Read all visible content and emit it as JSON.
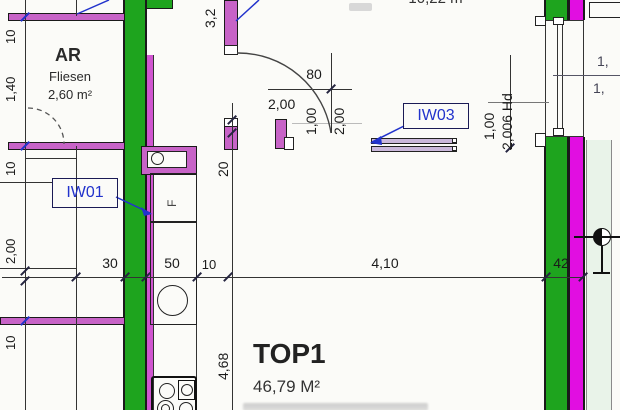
{
  "plan": {
    "rooms": {
      "ar": {
        "label": "AR",
        "finish": "Fliesen",
        "area": "2,60 m²"
      },
      "top1": {
        "label": "TOP1",
        "area": "46,79 M²"
      },
      "upper": {
        "area": "10,22 m²"
      }
    },
    "wall_tags": {
      "iw01": "IW01",
      "iw03": "IW03"
    },
    "fixtures": {
      "f": "F"
    },
    "dims": {
      "left": [
        "10",
        "1,40",
        "10",
        "2,00",
        "10"
      ],
      "bottom": [
        "30",
        "50",
        "10",
        "4,10",
        "42"
      ],
      "v32": "3,2",
      "v20": "20",
      "v468": "4,68",
      "door80": "80",
      "door200": "2,00",
      "door100v": "1,00",
      "door200v": "2,00",
      "right100": "1,00",
      "right200hd": "2,006 Hd",
      "win_up": "1,",
      "win_dn": "1,"
    },
    "colors": {
      "wall_green": "#1ea41e",
      "wall_magenta": "#e10ee1",
      "wall_orchid": "#c763c7",
      "tag_blue": "#2233cc",
      "balcony_strip": "#e9f3e9"
    }
  }
}
